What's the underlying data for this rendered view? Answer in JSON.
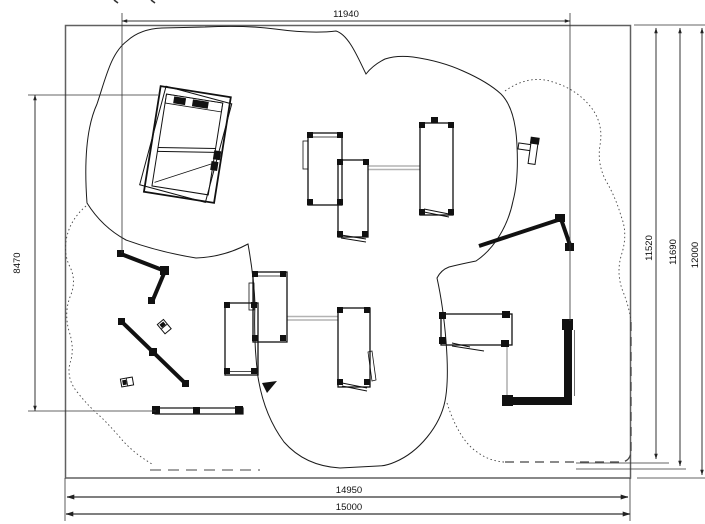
{
  "drawing": {
    "title": "playground-site-plan",
    "dimensions": {
      "top_width": "11940",
      "left_height": "8470",
      "right_heights": [
        "11520",
        "11690",
        "12000"
      ],
      "bottom_widths": [
        "14950",
        "15000"
      ]
    },
    "colors": {
      "line": "#111111",
      "dim_line": "#444444",
      "border": "#606060",
      "bridge": "#b3b3b3",
      "background": "#ffffff"
    }
  }
}
